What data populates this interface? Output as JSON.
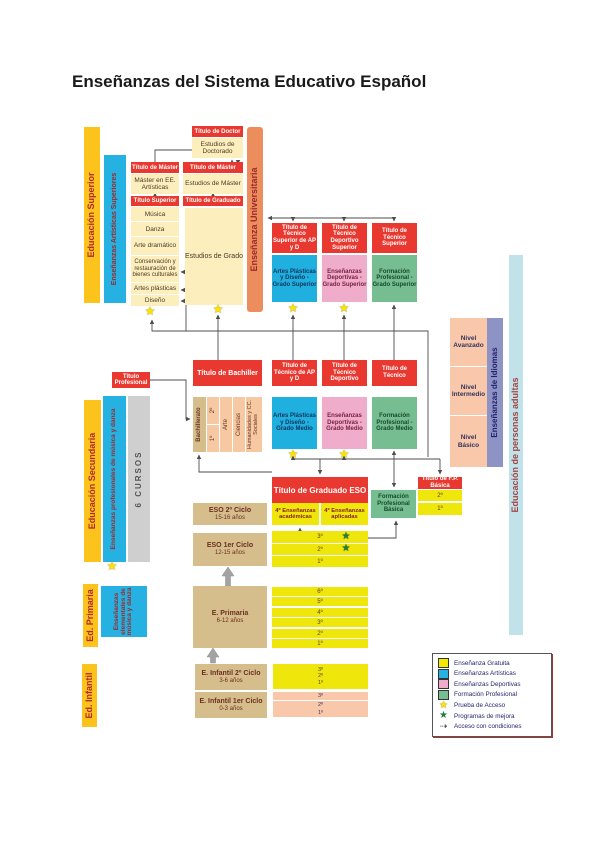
{
  "title": "Enseñanzas del Sistema Educativo Español",
  "icons": {
    "star": "★",
    "dashed_arrow": "⇢"
  },
  "strips": {
    "educacion_superior": "Educación Superior",
    "ens_art_sup": "Enseñanzas Artísticas Superiores",
    "ens_universitaria": "Enseñanza Universitaria",
    "educacion_secundaria": "Educación Secundaria",
    "ens_prof_musica": "Enseñanzas profesionales de música y danza",
    "cursos": "6 CURSOS",
    "ed_primaria": "Ed. Primaria",
    "ens_elementales": "Enseñanzas elementales de música y danza",
    "ed_infantil": "Ed. Infantil",
    "ens_idiomas": "Enseñanzas de Idiomas",
    "personas_adultas": "Educación de personas adultas"
  },
  "superior": {
    "titulo_doctor": "Título de Doctor",
    "estudios_doctorado": "Estudios de Doctorado",
    "titulo_master_art": "Título de Máster",
    "master_art": "Máster en EE. Artísticas",
    "titulo_superior": "Título Superior",
    "artisticas": [
      "Música",
      "Danza",
      "Arte dramático",
      "Conservación y restauración de bienes culturales",
      "Artes plásticas",
      "Diseño"
    ],
    "titulo_master": "Título de Máster",
    "estudios_master": "Estudios de Máster",
    "titulo_graduado": "Título de Graduado",
    "estudios_grado": "Estudios de Grado",
    "grupos": [
      {
        "titulo": "Título de Técnico Superior de AP y D",
        "cuerpo": "Artes Plásticas y Diseño - Grado Superior"
      },
      {
        "titulo": "Título de Técnico Deportivo Superior",
        "cuerpo": "Enseñanzas Deportivas - Grado Superior"
      },
      {
        "titulo": "Título de Técnico Superior",
        "cuerpo": "Formación Profesional - Grado Superior"
      }
    ]
  },
  "idiomas_niveles": [
    "Nivel Avanzado",
    "Nivel Intermedio",
    "Nivel Básico"
  ],
  "secundaria_post": {
    "titulo_profesional": "Título Profesional",
    "titulo_bachiller": "Título de Bachiller",
    "bachillerato": {
      "label": "Bachillerato",
      "cursos": [
        "2º",
        "1º"
      ],
      "modalidades": [
        "Arte",
        "Ciencias",
        "Humanidades y CC. Sociales"
      ]
    },
    "grupos": [
      {
        "titulo": "Título de Técnico de AP y D",
        "cuerpo": "Artes Plásticas y Diseño - Grado Medio"
      },
      {
        "titulo": "Título de Técnico Deportivo",
        "cuerpo": "Enseñanzas Deportivas - Grado Medio"
      },
      {
        "titulo": "Título de Técnico",
        "cuerpo": "Formación Profesional - Grado Medio"
      }
    ]
  },
  "eso": {
    "titulo": "Título de Graduado ESO",
    "fp_basica": {
      "titulo": "Título de F.P. Básica",
      "cuerpo": "Formación Profesional Básica",
      "cursos": [
        "2º",
        "1º"
      ]
    },
    "ciclo2": {
      "label": "ESO 2º Ciclo",
      "edad": "15-16 años"
    },
    "ciclo1": {
      "label": "ESO 1er Ciclo",
      "edad": "12-15 años"
    },
    "cuarto": [
      "4º Enseñanzas académicas",
      "4º Enseñanzas aplicadas"
    ],
    "cursos": [
      "3º",
      "2º",
      "1º"
    ]
  },
  "primaria": {
    "label": "E. Primaria",
    "edad": "6-12 años",
    "cursos": [
      "6º",
      "5º",
      "4º",
      "3º",
      "2º",
      "1º"
    ]
  },
  "infantil": {
    "ciclo2": {
      "label": "E. Infantil 2º Ciclo",
      "edad": "3-6 años",
      "cursos": [
        "3º",
        "2º",
        "1º"
      ]
    },
    "ciclo1": {
      "label": "E. Infantil 1er Ciclo",
      "edad": "0-3 años",
      "cursos": [
        "3º",
        "2º",
        "1º"
      ]
    }
  },
  "legend": {
    "items": [
      {
        "swatch": "yellow",
        "label": "Enseñanza Gratuita"
      },
      {
        "swatch": "blue",
        "label": "Enseñanzas Artísticas"
      },
      {
        "swatch": "pink",
        "label": "Enseñanzas Deportivas"
      },
      {
        "swatch": "green",
        "label": "Formación Profesional"
      },
      {
        "swatch": "star-yellow",
        "label": "Prueba de Acceso"
      },
      {
        "swatch": "star-green",
        "label": "Programas de mejora"
      },
      {
        "swatch": "arrow",
        "label": "Acceso con condiciones"
      }
    ]
  }
}
